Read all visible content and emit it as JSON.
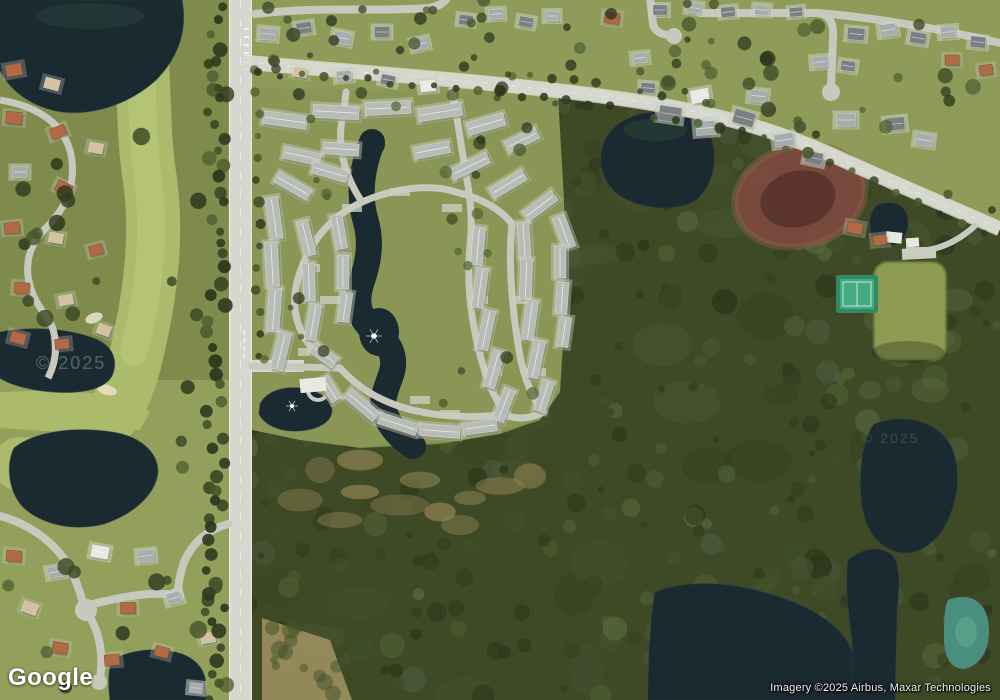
{
  "map": {
    "view_type": "satellite",
    "logo_text": "Google",
    "attribution_text": "Imagery ©2025 Airbus, Maxar Technologies",
    "watermark_text": "© 2025",
    "watermark_text_2": "© 2025"
  },
  "palette": {
    "suburbGrass": "#7e8b4d",
    "suburbGrassLight": "#93a05c",
    "topSuburb": "#8f9b59",
    "condoGrass": "#8a9656",
    "golf": "#abbb6b",
    "golfLight": "#bdcb7b",
    "forest": "#3e4926",
    "water": "#1b2931",
    "waterLight": "#2b3e48",
    "algae": "#2e4a3c",
    "marsh": "#7c4a3f",
    "marshDark": "#542f2a",
    "marshEdge": "#8a6248",
    "road": "#d6d7ce",
    "roadEdge": "#eeeee6",
    "roadMinor": "#c7c8be",
    "pad": "#cacdbf",
    "condoRoof": "#b8bcb6",
    "tennisOuter": "#2f8a65",
    "tennis": "#44ab81",
    "field": "#8d9b53",
    "fieldDark": "#6e7c40",
    "tealPond": "#4a8f7d",
    "sand": "#e8e0c2",
    "shadow": "rgba(22,28,12,0.38)",
    "roofOrange": "#b06a44",
    "roofTan": "#d3c2a2",
    "roofGray": "#a7adad",
    "roofDark": "#788082",
    "roofWhite": "#e8e9e3",
    "trees": [
      "#2f3a1e",
      "#3a4624",
      "#46542b",
      "#536233",
      "#2a331a"
    ],
    "forestTex": [
      "#36421f",
      "#41502a",
      "#4c5c31",
      "#2d371b",
      "#55663a",
      "#49593a"
    ],
    "scrubTan": "#8f8252",
    "scrubTan2": "#a29461"
  }
}
